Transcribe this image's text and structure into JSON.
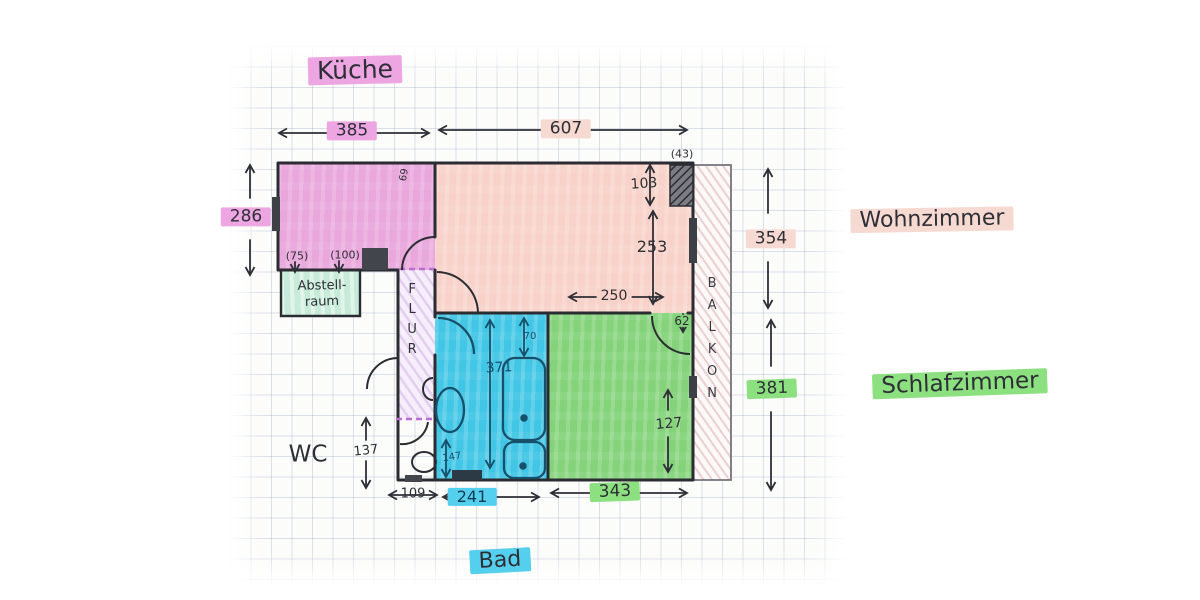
{
  "labels": {
    "kueche": "Küche",
    "wohnzimmer": "Wohnzimmer",
    "schlafzimmer": "Schlafzimmer",
    "bad": "Bad",
    "abstell_line1": "Abstell-",
    "abstell_line2": "raum",
    "flur": "FLUR",
    "wc": "WC",
    "balkon": "BALKON"
  },
  "dims": {
    "kitchen_width": "385",
    "living_width": "607",
    "kitchen_height": "286",
    "living_height": "354",
    "bedroom_height": "381",
    "wc_width": "109",
    "bath_width": "241",
    "bedroom_width": "343",
    "shaft_width": "(43)",
    "shaft_height": "103",
    "living_right_height": "253",
    "living_inner_width": "250",
    "balcony_door_offset": "62",
    "bedroom_door_offset": "127",
    "bath_height": "371",
    "bath_top_offset": "70",
    "bath_corner": "147",
    "wc_height": "137",
    "storage_door": "(75)",
    "storage_opening": "(100)",
    "kitchen_door": "69"
  },
  "colors": {
    "kitchen": "#e9a7dc",
    "living": "#f8d2c9",
    "bedroom": "#84d37a",
    "bath": "#41c6e6",
    "storage": "#c6ebd9",
    "highlight_magenta": "#eda6e2",
    "highlight_pink": "#f6dad2",
    "highlight_green": "#8ce07f",
    "highlight_cyan": "#55cfee",
    "ink": "#2e2f36",
    "ink_blue": "#17506a"
  }
}
